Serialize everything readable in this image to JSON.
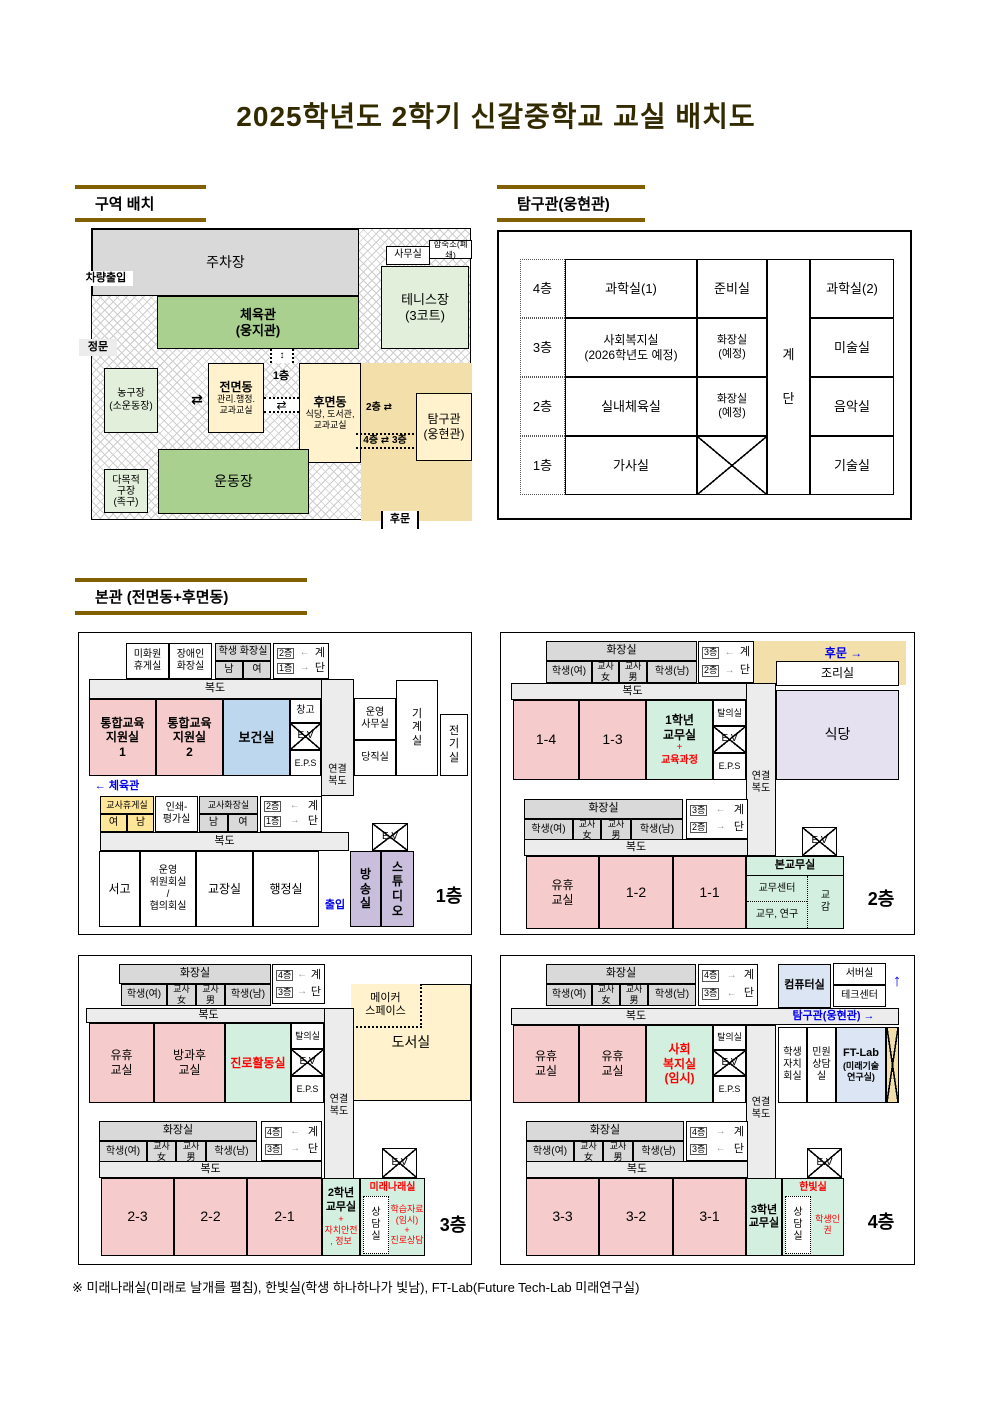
{
  "header": {
    "title": "2025학년도 2학기 신갈중학교 교실 배치도"
  },
  "sections": {
    "zone": "구역 배치",
    "tamgu": "탐구관(웅현관)",
    "main": "본관 (전면동+후면동)"
  },
  "campus": {
    "parking": "주차장",
    "vehicle_entry": "차량출입",
    "main_gate": "정문",
    "gym": "체육관\n(웅지관)",
    "office": "사무실",
    "dorm_closed": "합숙소(폐쇄)",
    "tennis": "테니스장\n(3코트)",
    "basketball": "농구장\n(소운동장)",
    "front_building": "전면동",
    "front_building_sub": "관리.행정.\n교과교실",
    "floor1_label": "1층",
    "updown_arrow": "↕",
    "swap_arrow": "⇄",
    "rear_building": "후면동",
    "rear_building_sub": "식당, 도서관,\n교과교실",
    "link_2f": "2층 ⇄",
    "link_4f3f": "4층 ⇄ 3층",
    "tamgu": "탐구관\n(웅현관)",
    "field": "운동장",
    "multi_court": "다목적\n구장\n(족구)",
    "back_gate": "후문"
  },
  "tamgu_table": {
    "floors": [
      "4층",
      "3층",
      "2층",
      "1층"
    ],
    "rows": [
      {
        "c1": "과학실(1)",
        "c2": "준비실",
        "c3": "과학실(2)"
      },
      {
        "c1": "사회복지실\n(2026학년도 예정)",
        "c2": "화장실\n(예정)",
        "c3": "미술실"
      },
      {
        "c1": "실내체육실",
        "c2": "화장실\n(예정)",
        "c3": "음악실"
      },
      {
        "c1": "가사실",
        "c2": "",
        "c3": "기술실"
      }
    ],
    "stairs": "계\n단"
  },
  "shared": {
    "corridor": "복도",
    "connect": "연결\n복도",
    "ev": "E.V",
    "eps": "E.P.S",
    "storage": "창고",
    "talui": "탈의실",
    "toilet": "화장실",
    "student_f": "학생(여)",
    "student_m": "학생(남)",
    "teacher_f": "교사\n女",
    "teacher_m": "교사\n男",
    "gye": "계",
    "dan": "단"
  },
  "f1": {
    "cleaner_room": "미화원\n휴게실",
    "disabled_toilet": "장애인\n화장실",
    "student_toilet": "학생 화장실",
    "male": "남",
    "female": "여",
    "stairs": {
      "top": "2층",
      "ta": "←",
      "bot": "1층",
      "ba": "→"
    },
    "tonghap1": "통합교육\n지원실\n1",
    "tonghap2": "통합교육\n지원실\n2",
    "bogeon": "보건실",
    "unyoung_office": "운영\n사무실",
    "dangjik": "당직실",
    "machine": "기\n계\n실",
    "electric": "전\n기\n실",
    "gym_link": "← 체육관",
    "teacher_rest": "교사휴게실",
    "rest_f": "여",
    "rest_m": "남",
    "print_room": "인쇄-\n평가실",
    "teacher_toilet": "교사화장실",
    "tt_m": "남",
    "tt_f": "여",
    "seogo": "서고",
    "committee": "운영\n위원회실\n/\n협의회실",
    "principal": "교장실",
    "admin": "행정실",
    "entrance": "출입",
    "broadcast": "방\n송\n실",
    "studio": "스\n튜\n디\n오",
    "floor_label": "1층"
  },
  "f2": {
    "stairs": {
      "top": "3층",
      "ta": "←",
      "bot": "2층",
      "ba": "→"
    },
    "back_gate": "후문  →",
    "cook": "조리실",
    "cafeteria": "식당",
    "r14": "1-4",
    "r13": "1-3",
    "office1": "1학년\n교무실",
    "plus": "+",
    "curriculum": "교육과정",
    "yuhyu": "유휴\n교실",
    "r12": "1-2",
    "r11": "1-1",
    "main_office": "본교무실",
    "center": "교무센터",
    "gyomu": "교무, 연구",
    "vice": "교\n감",
    "floor_label": "2층"
  },
  "f3": {
    "stairs": {
      "top": "4층",
      "ta": "←",
      "bot": "3층",
      "ba": "→"
    },
    "maker": "메이커\n스페이스",
    "library": "도서실",
    "yuhyu": "유휴\n교실",
    "after_school": "방과후\n교실",
    "career": "진로활동실",
    "r23": "2-3",
    "r22": "2-2",
    "r21": "2-1",
    "office2": "2학년\n교무실",
    "office2_sub": "+\n자치안전\n, 정보",
    "mirae": "미래나래실",
    "counsel": "상\n담\n실",
    "study": "학습자료\n(임시)\n+\n진로상담",
    "floor_label": "3층"
  },
  "f4": {
    "stairs": {
      "top": "4층",
      "ta": "→",
      "bot": "3층",
      "ba": "←"
    },
    "computer": "컴퓨터실",
    "server": "서버실",
    "tech": "테크센터",
    "up_arrow": "↑",
    "tamgu_link": "탐구관(웅현관) →",
    "yuhyu1": "유휴\n교실",
    "yuhyu2": "유휴\n교실",
    "welfare": "사회\n복지실\n(임시)",
    "jachi": "학생\n자치\n회실",
    "minwon": "민원\n상담\n실",
    "ftlab": "FT-Lab",
    "ftlab_sub": "(미래기술\n연구실)",
    "r33": "3-3",
    "r32": "3-2",
    "r31": "3-1",
    "office3": "3학년\n교무실",
    "hanbit": "한빛실",
    "counsel": "상\n담\n실",
    "rights": "학생인권",
    "floor_label": "4층"
  },
  "footnote": "※ 미래나래실(미래로 날개를 펼침), 한빛실(학생 하나하나가 빛남), FT-Lab(Future Tech-Lab 미래연구실)"
}
